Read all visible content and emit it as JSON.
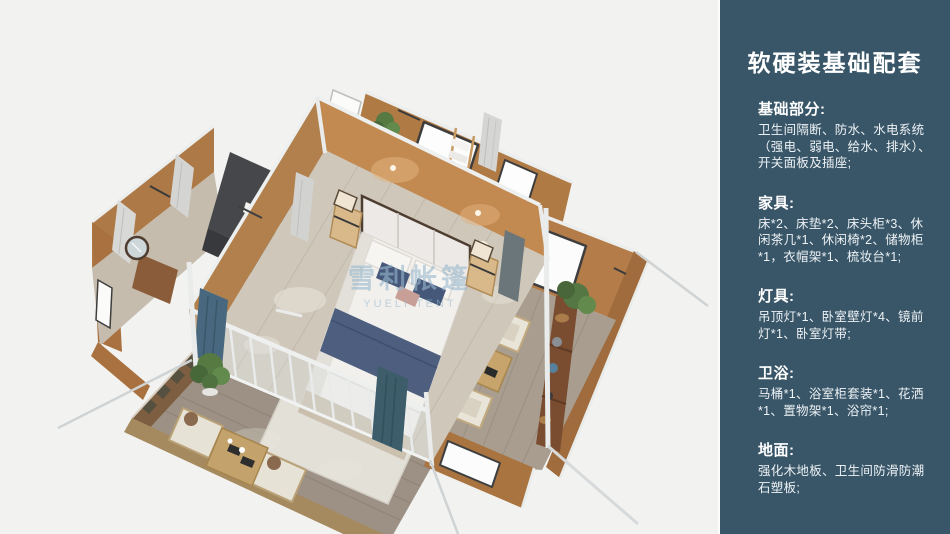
{
  "panel": {
    "title": "软硬装基础配套",
    "sections": [
      {
        "heading": "基础部分:",
        "body": "卫生间隔断、防水、水电系统（强电、弱电、给水、排水）、开关面板及插座;"
      },
      {
        "heading": "家具:",
        "body": "床*2、床垫*2、床头柜*3、休闲茶几*1、休闲椅*2、储物柜*1，衣帽架*1、梳妆台*1;"
      },
      {
        "heading": "灯具:",
        "body": "吊顶灯*1、卧室壁灯*4、镜前灯*1、卧室灯带;"
      },
      {
        "heading": "卫浴:",
        "body": "马桶*1、浴室柜套装*1、花洒*1、置物架*1、浴帘*1;"
      },
      {
        "heading": "地面:",
        "body": "强化木地板、卫生间防滑防潮石塑板;"
      }
    ]
  },
  "illustration": {
    "watermark_cn": "雪利帐篷",
    "watermark_en": "YUELI TENT"
  },
  "colors": {
    "sidebar_bg": "#395668",
    "background": "#f2f2f1",
    "wall_tan": "#b9834e",
    "wall_orange": "#c28950",
    "floor_light": "#cfc7ba",
    "deck_wood": "#9c9184",
    "frame_white": "#edf0ef",
    "bed_navy": "#4d5e7f",
    "curtain_teal": "#47687e",
    "plant_green": "#567a42"
  }
}
